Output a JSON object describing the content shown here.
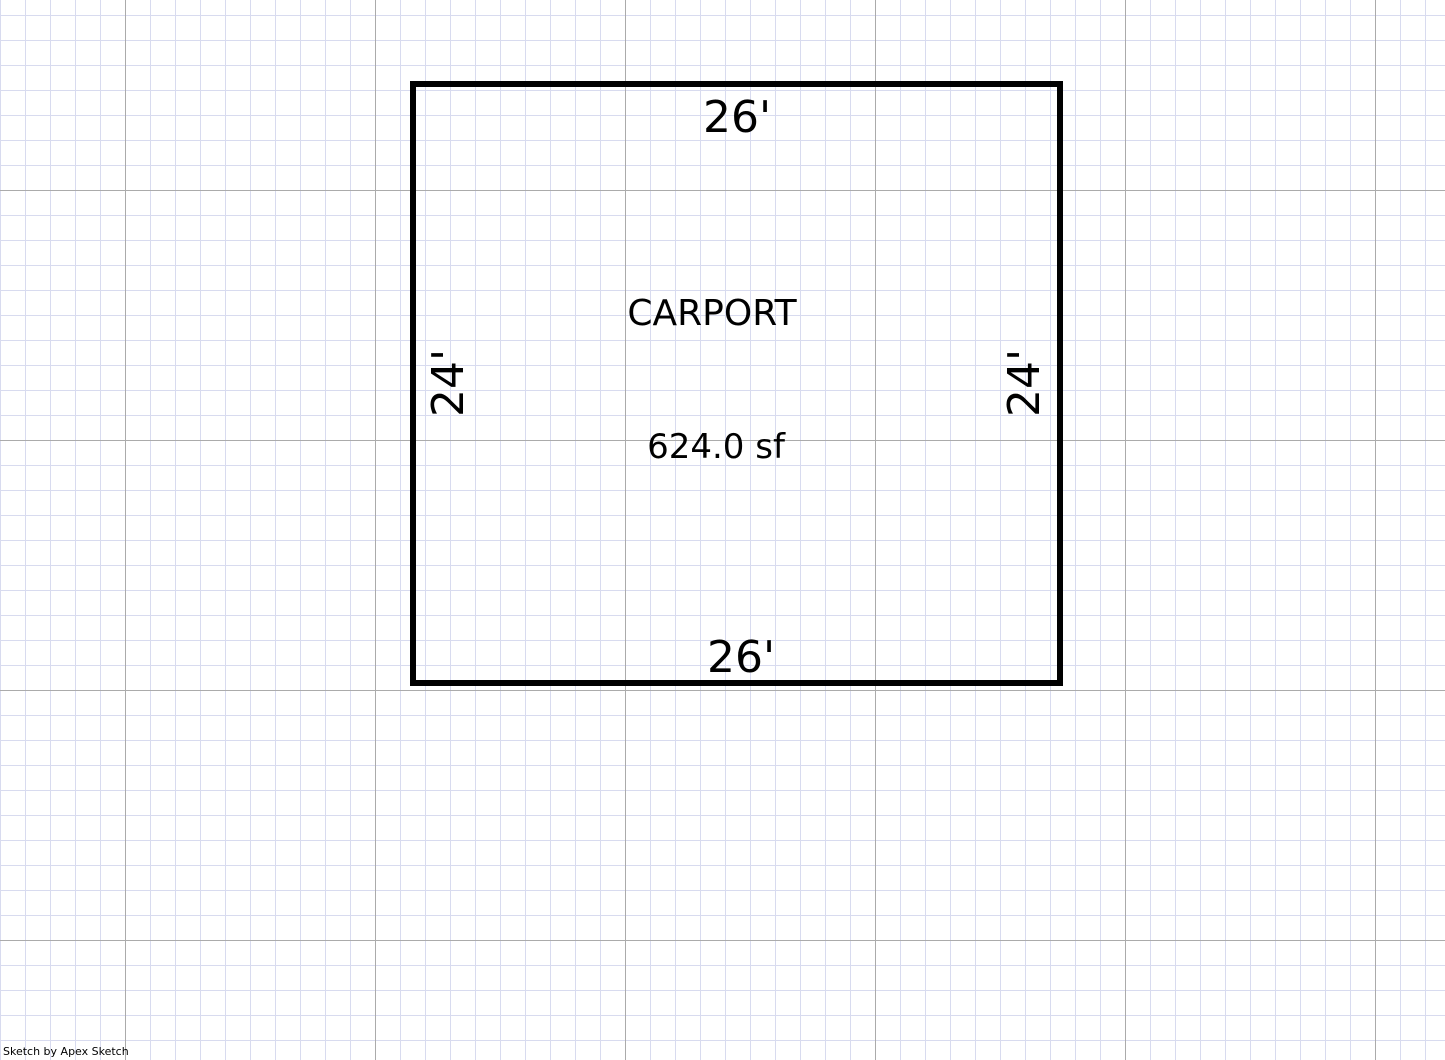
{
  "canvas": {
    "grid": {
      "minor_color": "#d8dbef",
      "major_color": "#ababab",
      "minor_step_px": 25,
      "major_step_px": 250,
      "scale_px_per_ft": 25
    }
  },
  "sketch": {
    "outline_color": "#000000",
    "room": {
      "name": "CARPORT",
      "area": "624.0 sf",
      "dim_top": "26'",
      "dim_bottom": "26'",
      "dim_left": "24'",
      "dim_right": "24'"
    }
  },
  "watermark": {
    "text": "Sketch by Apex Sketch"
  }
}
